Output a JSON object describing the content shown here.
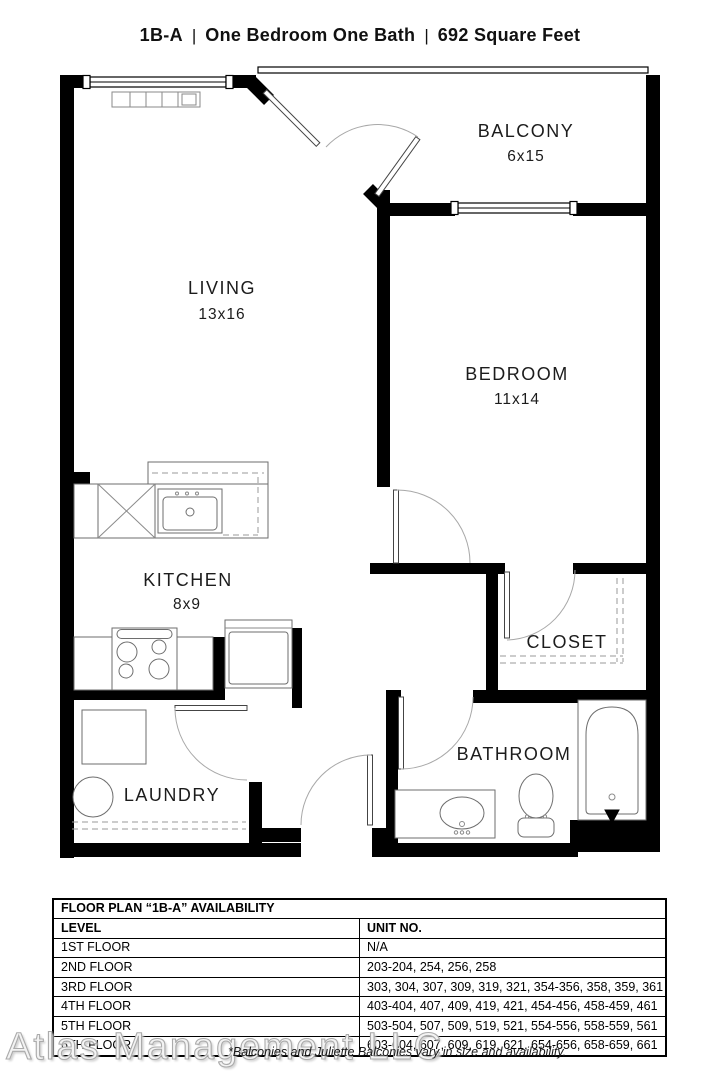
{
  "header": {
    "plan_code": "1B-A",
    "separator": "|",
    "description": "One Bedroom One Bath",
    "area": "692 Square Feet"
  },
  "rooms": {
    "living": {
      "name": "LIVING",
      "dims": "13x16"
    },
    "balcony": {
      "name": "BALCONY",
      "dims": "6x15"
    },
    "bedroom": {
      "name": "BEDROOM",
      "dims": "11x14"
    },
    "kitchen": {
      "name": "KITCHEN",
      "dims": "8x9"
    },
    "closet": {
      "name": "CLOSET"
    },
    "bathroom": {
      "name": "BATHROOM"
    },
    "laundry": {
      "name": "LAUNDRY"
    }
  },
  "availability": {
    "title": "FLOOR PLAN “1B-A” AVAILABILITY",
    "columns": [
      "LEVEL",
      "UNIT NO."
    ],
    "rows": [
      [
        "1ST FLOOR",
        "N/A"
      ],
      [
        "2ND FLOOR",
        "203-204, 254, 256, 258"
      ],
      [
        "3RD FLOOR",
        "303, 304, 307, 309, 319, 321, 354-356, 358, 359, 361"
      ],
      [
        "4TH FLOOR",
        "403-404, 407, 409, 419, 421, 454-456, 458-459, 461"
      ],
      [
        "5TH FLOOR",
        "503-504, 507, 509, 519, 521, 554-556, 558-559, 561"
      ],
      [
        "6TH FLOOR",
        "603-604, 607, 609, 619, 621, 654-656, 658-659, 661"
      ]
    ]
  },
  "footer": {
    "watermark": "Atlas Management LLC",
    "note": "*Balconies and Juliette Balconies vary in size and availability."
  },
  "colors": {
    "wall": "#000000",
    "background": "#ffffff"
  }
}
